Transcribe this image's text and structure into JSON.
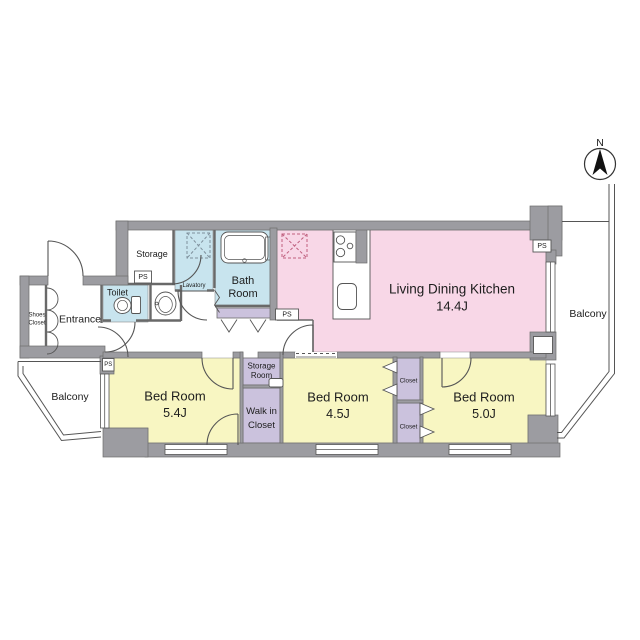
{
  "compass": {
    "label": "N"
  },
  "labels": {
    "ps": "PS"
  },
  "colors": {
    "wall": "#9c9ca1",
    "room_pink": "#f8d7e7",
    "room_yellow": "#f8f6c2",
    "room_blue": "#c8e4ee",
    "room_purple": "#cbc2dd",
    "line": "#555555"
  },
  "rooms": {
    "ldk": {
      "name": "Living Dining Kitchen",
      "size": "14.4J"
    },
    "bed1": {
      "name": "Bed Room",
      "size": "5.4J"
    },
    "bed2": {
      "name": "Bed Room",
      "size": "4.5J"
    },
    "bed3": {
      "name": "Bed Room",
      "size": "5.0J"
    },
    "bath": {
      "line1": "Bath",
      "line2": "Room"
    },
    "toilet": {
      "name": "Toilet"
    },
    "lavatory": {
      "name": "Lavatory"
    },
    "storage": {
      "name": "Storage"
    },
    "entrance": {
      "name": "Entrance"
    },
    "shoes_closet": {
      "line1": "Shoes",
      "line2": "Closet"
    },
    "storage_room": {
      "line1": "Storage",
      "line2": "Room"
    },
    "walk_in_closet": {
      "line1": "Walk in",
      "line2": "Closet"
    },
    "closet_a": {
      "name": "Closet"
    },
    "closet_b": {
      "name": "Closet"
    },
    "balcony_left": {
      "name": "Balcony"
    },
    "balcony_right": {
      "name": "Balcony"
    }
  }
}
